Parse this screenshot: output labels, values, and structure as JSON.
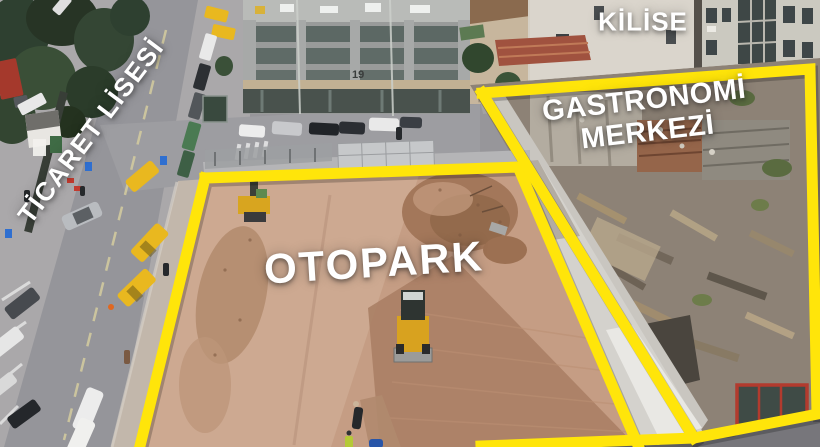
{
  "annotations": {
    "ticaret_lisesi": {
      "text": "TİCARET LİSESİ"
    },
    "kilise": {
      "text": "KİLİSE"
    },
    "gastronomi_merkezi": {
      "line1": "GASTRONOMİ",
      "line2": "MERKEZİ"
    },
    "otopark": {
      "text": "OTOPARK"
    }
  },
  "scene": {
    "building_sign": "19"
  },
  "colors": {
    "highlight_outline": "#ffe50a",
    "label_text": "#ffffff",
    "dirt_lot": "#c59d84",
    "road": "#95959a",
    "taxi_yellow": "#e9b81f"
  }
}
